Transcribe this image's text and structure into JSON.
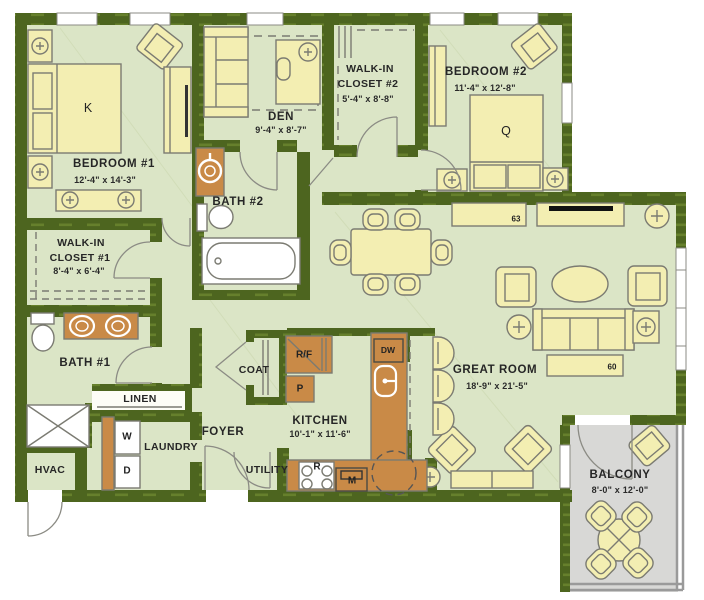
{
  "plan": {
    "rooms": {
      "bedroom1": {
        "name": "BEDROOM #1",
        "dims": "12'-4\" x 14'-3\""
      },
      "walk_in_closet1": {
        "name1": "WALK-IN",
        "name2": "CLOSET #1",
        "dims": "8'-4\" x 6'-4\""
      },
      "bath1": {
        "name": "BATH #1"
      },
      "den": {
        "name": "DEN",
        "dims": "9'-4\" x 8'-7\""
      },
      "bath2": {
        "name": "BATH #2"
      },
      "walk_in_closet2": {
        "name1": "WALK-IN",
        "name2": "CLOSET #2",
        "dims": "5'-4\" x 8'-8\""
      },
      "bedroom2": {
        "name": "BEDROOM #2",
        "dims": "11'-4\" x 12'-8\""
      },
      "great_room": {
        "name": "GREAT ROOM",
        "dims": "18'-9\" x 21'-5\""
      },
      "kitchen": {
        "name": "KITCHEN",
        "dims": "10'-1\" x 11'-6\""
      },
      "balcony": {
        "name": "BALCONY",
        "dims": "8'-0\" x 12'-0\""
      },
      "foyer": {
        "name": "FOYER"
      },
      "coat": {
        "name": "COAT"
      },
      "linen": {
        "name": "LINEN"
      },
      "laundry": {
        "name": "LAUNDRY"
      },
      "utility": {
        "name": "UTILITY"
      },
      "hvac": {
        "name": "HVAC"
      }
    },
    "fixtures": {
      "king_bed": "K",
      "queen_bed": "Q",
      "washer": "W",
      "dryer": "D",
      "refrigerator": "R/F",
      "pantry": "P",
      "dishwasher": "DW",
      "range": "R",
      "microwave": "M",
      "tv_size_great_room_north": "63",
      "tv_size_great_room_south": "60"
    },
    "colors": {
      "wall": "#4d651f",
      "wall_dash": "#66802c",
      "floor": "#dbe5c6",
      "furniture": "#f3eeb2",
      "cabinet": "#c98a47",
      "balcony_floor": "#d8d8d6",
      "outline": "#7b7b72"
    }
  }
}
